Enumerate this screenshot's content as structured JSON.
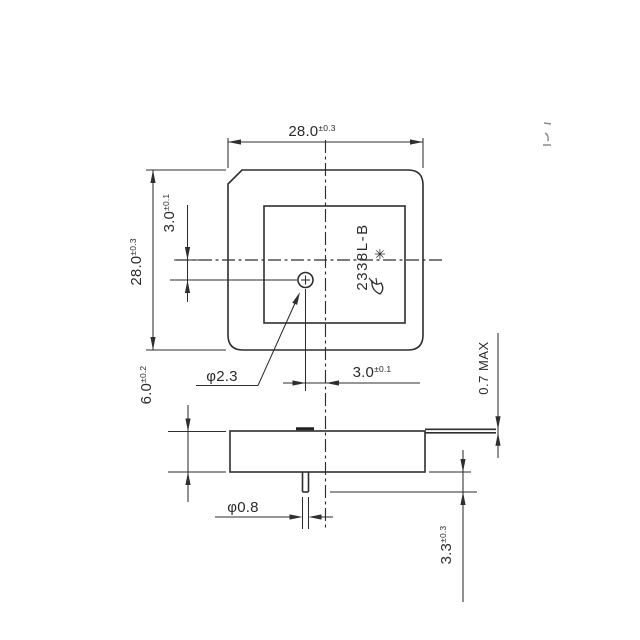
{
  "drawing": {
    "type": "mechanical-drawing",
    "background_color": "#ffffff",
    "line_color": "#2e2e2e",
    "marking": {
      "part_number": "2338L-B",
      "star_symbol": "✳"
    },
    "dimensions": {
      "width_top": {
        "value": "28.0",
        "tol": "±0.3"
      },
      "height_left": {
        "value": "28.0",
        "tol": "±0.3"
      },
      "feed_offset_vertical": {
        "value": "3.0",
        "tol": "±0.1"
      },
      "feed_offset_horizontal": {
        "value": "3.0",
        "tol": "±0.1"
      },
      "feed_hole_diameter": {
        "value": "φ2.3"
      },
      "body_thickness": {
        "value": "6.0",
        "tol": "±0.2"
      },
      "tab_thickness_max": {
        "value": "0.7 MAX"
      },
      "pin_diameter": {
        "value": "φ0.8"
      },
      "pin_length": {
        "value": "3.3",
        "tol": "±0.3"
      }
    }
  }
}
